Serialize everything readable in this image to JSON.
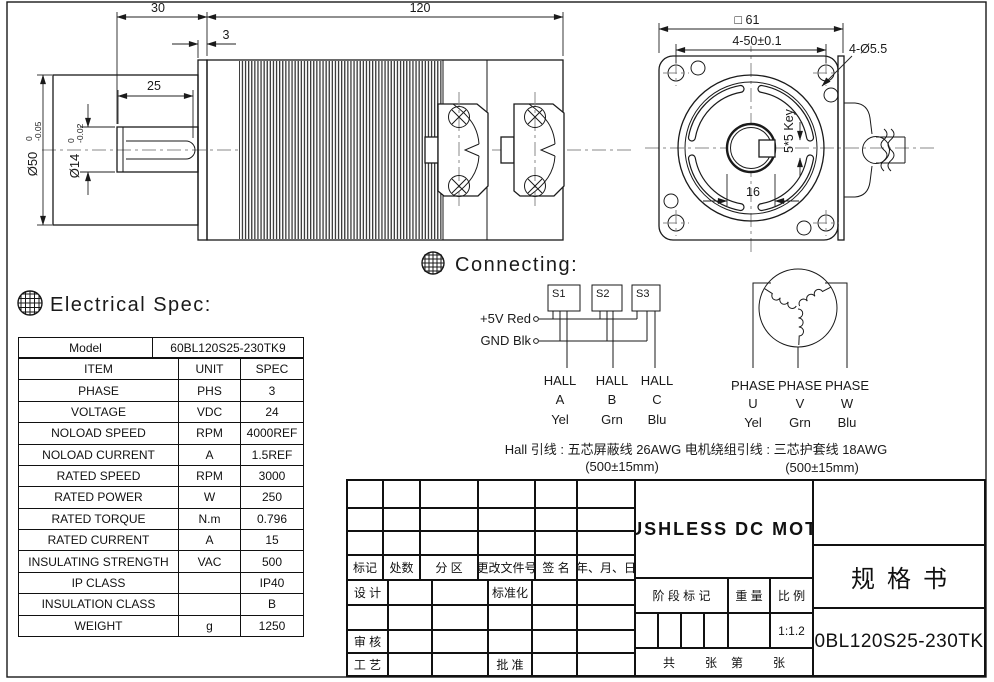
{
  "side_view": {
    "dim_30": "30",
    "dim_120": "120",
    "dim_3": "3",
    "dim_25": "25",
    "dia50_main": "Ø50",
    "dia50_tol_top": "0",
    "dia50_tol_bot": "-0.05",
    "dia14_main": "Ø14",
    "dia14_tol_top": "0",
    "dia14_tol_bot": "-0.02"
  },
  "front_view": {
    "dim_square": "□ 61",
    "dim_hole_spacing": "4-50±0.1",
    "dim_holes": "4-Ø5.5",
    "dim_key": "5*5 Key",
    "dim_bore": "16"
  },
  "electrical": {
    "heading": "Electrical Spec:",
    "model_label": "Model",
    "model_value": "60BL120S25-230TK9",
    "col_item": "ITEM",
    "col_unit": "UNIT",
    "col_spec": "SPEC",
    "rows": [
      {
        "item": "PHASE",
        "unit": "PHS",
        "spec": "3"
      },
      {
        "item": "VOLTAGE",
        "unit": "VDC",
        "spec": "24"
      },
      {
        "item": "NOLOAD SPEED",
        "unit": "RPM",
        "spec": "4000REF"
      },
      {
        "item": "NOLOAD CURRENT",
        "unit": "A",
        "spec": "1.5REF"
      },
      {
        "item": "RATED SPEED",
        "unit": "RPM",
        "spec": "3000"
      },
      {
        "item": "RATED POWER",
        "unit": "W",
        "spec": "250"
      },
      {
        "item": "RATED TORQUE",
        "unit": "N.m",
        "spec": "0.796"
      },
      {
        "item": "RATED CURRENT",
        "unit": "A",
        "spec": "15"
      },
      {
        "item": "INSULATING STRENGTH",
        "unit": "VAC",
        "spec": "500"
      },
      {
        "item": "IP CLASS",
        "unit": "",
        "spec": "IP40"
      },
      {
        "item": "INSULATION CLASS",
        "unit": "",
        "spec": "B"
      },
      {
        "item": "WEIGHT",
        "unit": "g",
        "spec": "1250"
      }
    ]
  },
  "connecting": {
    "heading": "Connecting:",
    "plus5v": "+5V Red",
    "gnd": "GND Blk",
    "s1": "S1",
    "s2": "S2",
    "s3": "S3",
    "halls": [
      {
        "line1": "HALL",
        "line2": "A",
        "line3": "Yel"
      },
      {
        "line1": "HALL",
        "line2": "B",
        "line3": "Grn"
      },
      {
        "line1": "HALL",
        "line2": "C",
        "line3": "Blu"
      }
    ],
    "hall_note1": "Hall 引线 : 五芯屏蔽线 26AWG",
    "hall_note2": "(500±15mm)",
    "phases": [
      {
        "line1": "PHASE",
        "line2": "U",
        "line3": "Yel"
      },
      {
        "line1": "PHASE",
        "line2": "V",
        "line3": "Grn"
      },
      {
        "line1": "PHASE",
        "line2": "W",
        "line3": "Blu"
      }
    ],
    "phase_note1": "电机绕组引线 : 三芯护套线 18AWG",
    "phase_note2": "(500±15mm)"
  },
  "title_block": {
    "rev_headers": [
      "标记",
      "处数",
      "分 区",
      "更改文件号",
      "签 名",
      "年、月、日"
    ],
    "design": "设 计",
    "standardization": "标准化",
    "review": "审 核",
    "process": "工 艺",
    "approve": "批 准",
    "product_name": "BRUSHLESS DC MOTOR",
    "stage_label": "阶 段 标 记",
    "weight_label": "重 量",
    "scale_label": "比 例",
    "scale_value": "1:1.2",
    "total_label": "共",
    "total_unit": "张",
    "page_label": "第",
    "page_unit": "张",
    "doc_type": "规格书",
    "part_number": "60BL120S25-230TK9"
  }
}
